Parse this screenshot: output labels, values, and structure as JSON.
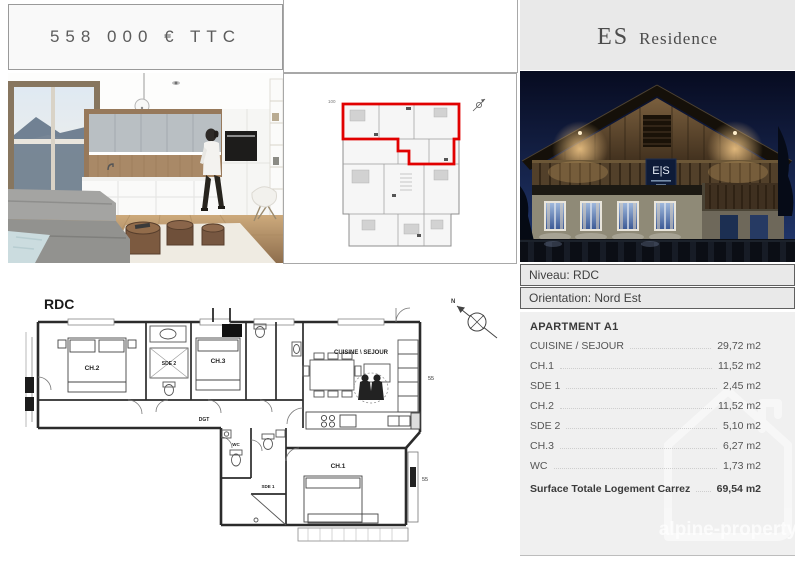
{
  "header": {
    "price": "558 000 € TTC",
    "residence_abbr": "ES",
    "residence_name": "Residence",
    "facade_sign": "E|S"
  },
  "info": {
    "niveau": "Niveau: RDC",
    "orientation": "Orientation: Nord Est"
  },
  "apartment": {
    "title": "APARTMENT A1",
    "rooms": [
      {
        "label": "CUISINE / SEJOUR",
        "area": "29,72 m2"
      },
      {
        "label": "CH.1",
        "area": "11,52 m2"
      },
      {
        "label": "SDE 1",
        "area": "2,45 m2"
      },
      {
        "label": "CH.2",
        "area": "11,52 m2"
      },
      {
        "label": "SDE 2",
        "area": "5,10 m2"
      },
      {
        "label": "CH.3",
        "area": "6,27 m2"
      },
      {
        "label": "WC",
        "area": "1,73 m2"
      }
    ],
    "total": {
      "label": "Surface Totale Logement Carrez",
      "area": "69,54 m2"
    }
  },
  "floorplan": {
    "level": "RDC",
    "rooms": {
      "ch2": "CH.2",
      "sde2": "SDE 2",
      "ch3": "CH.3",
      "dgt": "DGT",
      "cuisine": "CUISINE \\ SEJOUR",
      "ch1": "CH.1",
      "wc": "WC",
      "sde1": "SDE 1"
    },
    "dims": {
      "d1": "55",
      "d2": "55",
      "d3": "100"
    }
  },
  "watermark": {
    "text": "alpine-property"
  },
  "colors": {
    "highlight_red": "#e10000",
    "header_gray": "#e9e9e9",
    "panel_gray": "#f0f0f0",
    "night_sky": "#20356b"
  }
}
